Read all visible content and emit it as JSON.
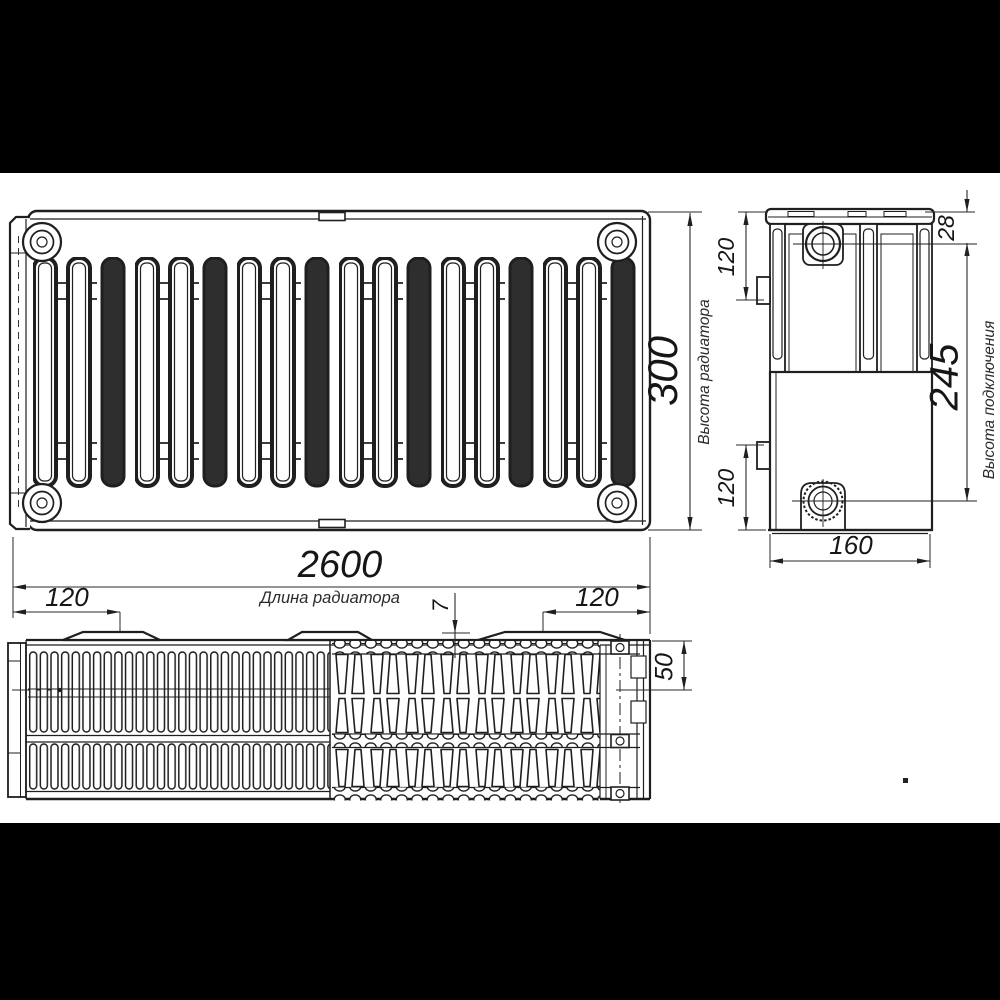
{
  "drawing": {
    "kind": "panel radiator technical drawing, three views",
    "colors": {
      "line": "#1f1f1f",
      "background": "#ffffff",
      "letterbox": "#000000"
    },
    "dimensions": {
      "length": {
        "value": "2600",
        "label": "Длина радиатора"
      },
      "height": {
        "value": "300",
        "label": "Высота радиатора"
      },
      "connection_height": {
        "value": "245",
        "label": "Высота подключения"
      },
      "depth": {
        "value": "160"
      },
      "top_offset": {
        "value": "28"
      },
      "side_port_top": {
        "value": "120"
      },
      "side_port_bottom": {
        "value": "120"
      },
      "bracket_left": {
        "value": "120"
      },
      "bracket_right": {
        "value": "120"
      },
      "grille_step": {
        "value": "7"
      },
      "axis_offset": {
        "value": "50"
      }
    }
  }
}
